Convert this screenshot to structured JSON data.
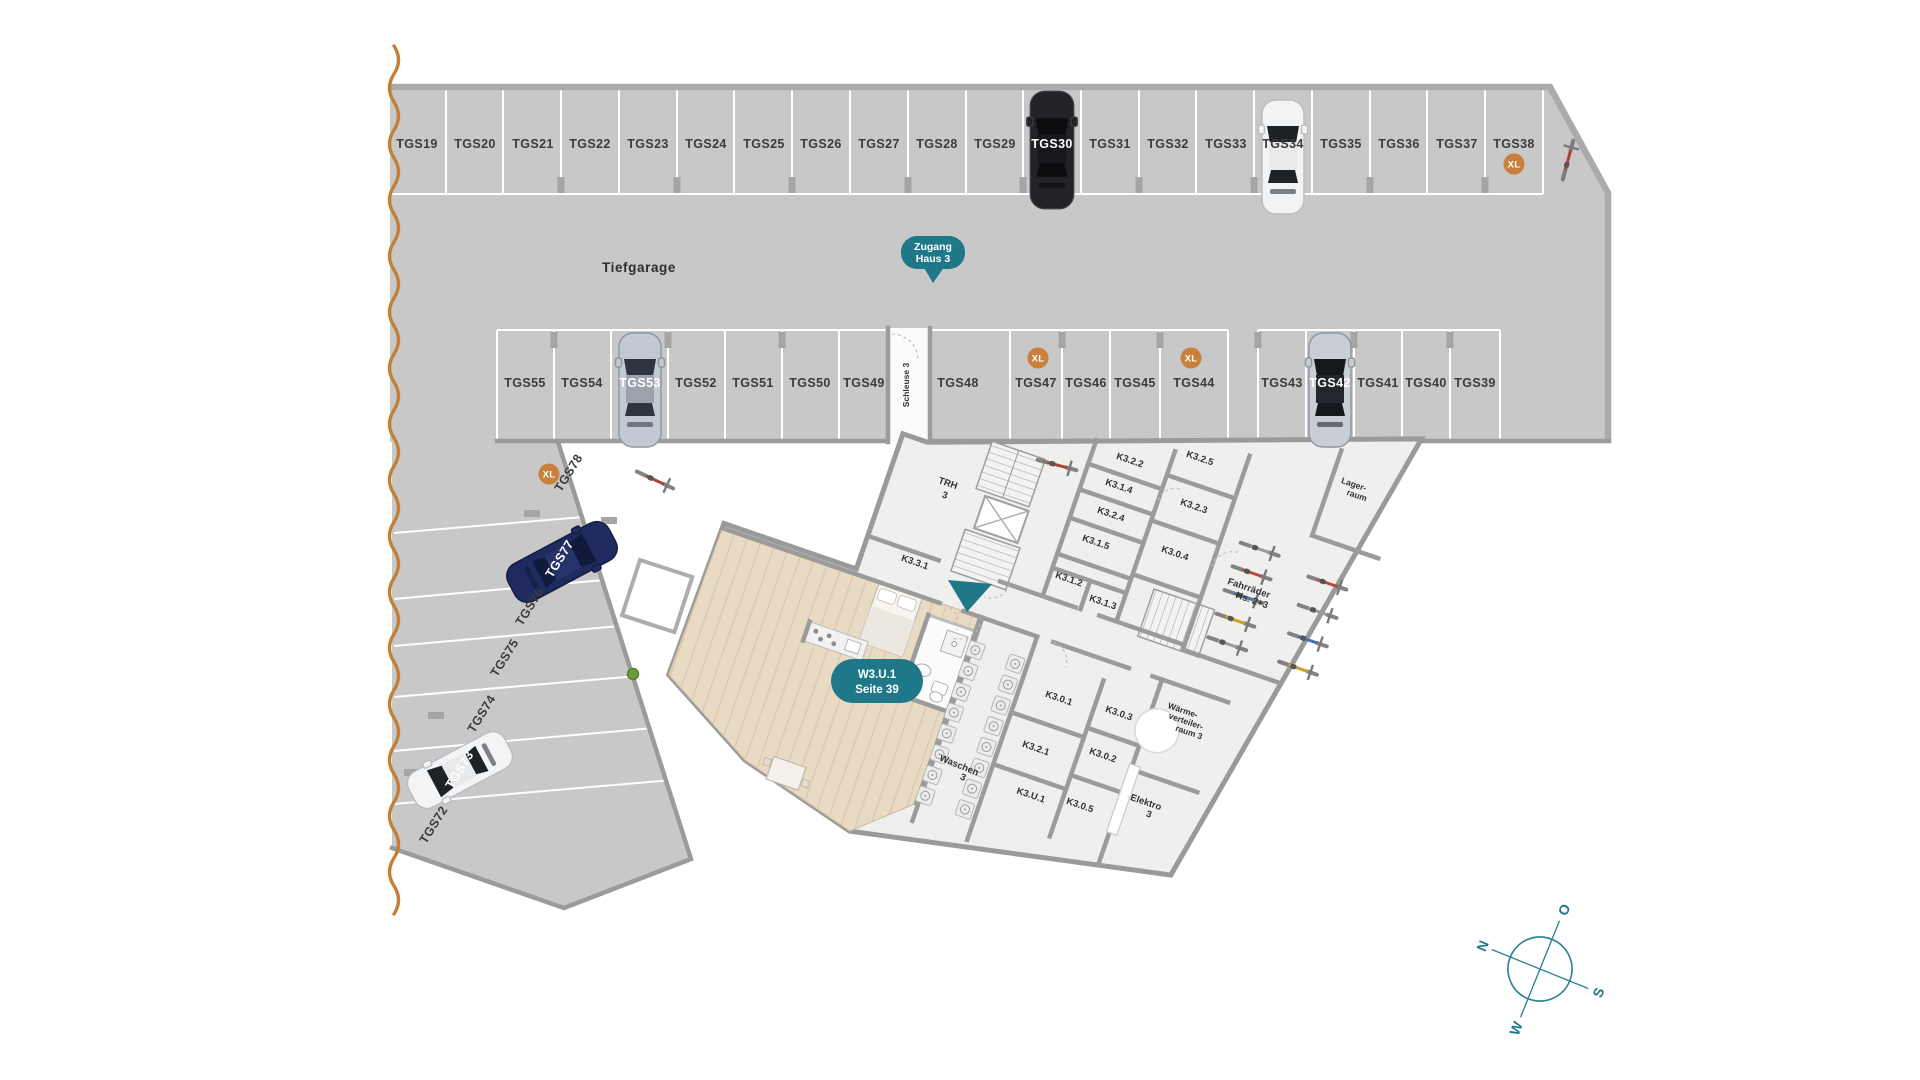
{
  "plan": {
    "area_label": "Tiefgarage"
  },
  "badges": {
    "xl": "XL",
    "zugang": [
      "Zugang",
      "Haus 3"
    ],
    "unit": [
      "W3.U.1",
      "Seite 39"
    ]
  },
  "stalls": {
    "top": [
      "TGS19",
      "TGS20",
      "TGS21",
      "TGS22",
      "TGS23",
      "TGS24",
      "TGS25",
      "TGS26",
      "TGS27",
      "TGS28",
      "TGS29",
      "TGS30",
      "TGS31",
      "TGS32",
      "TGS33",
      "TGS34",
      "TGS35",
      "TGS36",
      "TGS37",
      "TGS38"
    ],
    "middle_left": [
      "TGS55",
      "TGS54",
      "TGS53",
      "TGS52",
      "TGS51",
      "TGS50",
      "TGS49"
    ],
    "middle_right": [
      "TGS48",
      "TGS47",
      "TGS46",
      "TGS45",
      "TGS44",
      "TGS43",
      "TGS42",
      "TGS41",
      "TGS40",
      "TGS39"
    ],
    "west_wing": [
      "TGS78",
      "TGS77",
      "TGS76",
      "TGS75",
      "TGS74",
      "TGS73",
      "TGS72"
    ]
  },
  "rooms": {
    "schleuse": "Schleuse 3",
    "trh": [
      "TRH",
      "3"
    ],
    "k331": "K3.3.1",
    "k322": "K3.2.2",
    "k314": "K3.1.4",
    "k324": "K3.2.4",
    "k315": "K3.1.5",
    "k312": "K3.1.2",
    "k313": "K3.1.3",
    "k325": "K3.2.5",
    "k323": "K3.2.3",
    "k304": "K3.0.4",
    "lager": [
      "Lager-",
      "raum"
    ],
    "fahrraeder": [
      "Fahrräder",
      "Hs. 2+3"
    ],
    "waschen": [
      "Waschen",
      "3"
    ],
    "k301": "K3.0.1",
    "k303": "K3.0.3",
    "k321": "K3.2.1",
    "k302": "K3.0.2",
    "waerme": [
      "Wärme-",
      "verteiler-",
      "raum 3"
    ],
    "ku1": "K3.U.1",
    "k305": "K3.0.5",
    "elektro": [
      "Elektro",
      "3"
    ]
  },
  "compass": {
    "n": "N",
    "e": "O",
    "s": "S",
    "w": "W"
  },
  "colors": {
    "teal": "#1e7888",
    "orange_badge": "#c8803b",
    "wave_orange": "#c08038",
    "floor_gray": "#c8c8c9"
  }
}
